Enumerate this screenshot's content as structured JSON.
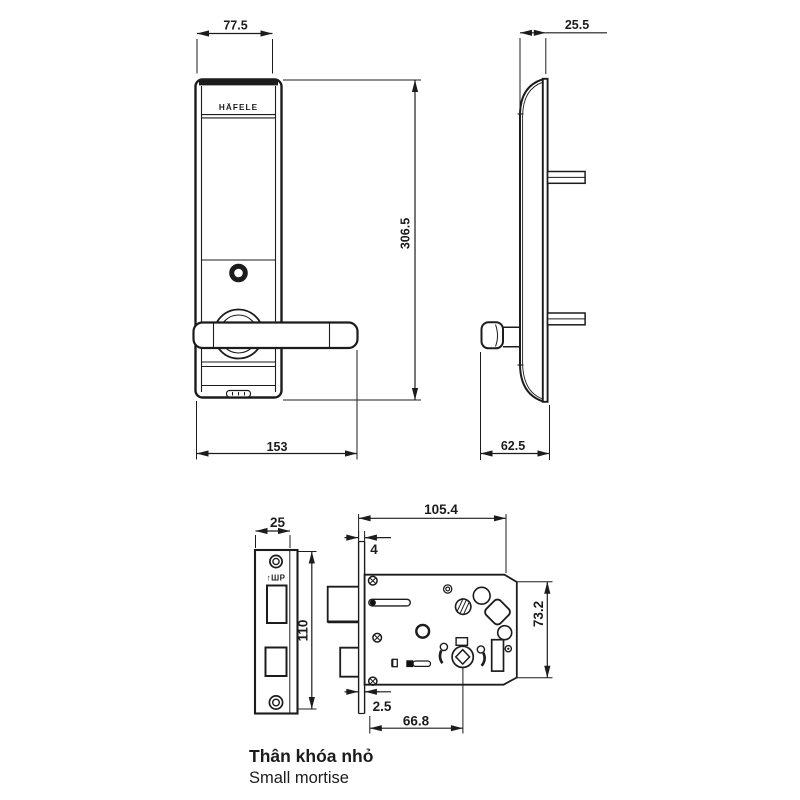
{
  "brand": "HÄFELE",
  "stamp": "↑ШP",
  "dims": {
    "front_width": "77.5",
    "front_height": "306.5",
    "front_total_width": "153",
    "side_depth": "25.5",
    "side_total_depth": "62.5",
    "faceplate_width": "25",
    "faceplate_height": "110",
    "body_width": "105.4",
    "faceplate_thickness": "4",
    "body_height": "73.2",
    "faceplate_lip": "2.5",
    "backset": "66.8"
  },
  "caption": {
    "title_vi": "Thân khóa nhỏ",
    "title_en": "Small mortise"
  },
  "colors": {
    "line": "#1c1c1c",
    "caption_primary": "#4d4d4d",
    "caption_secondary": "#9b9b9b"
  }
}
